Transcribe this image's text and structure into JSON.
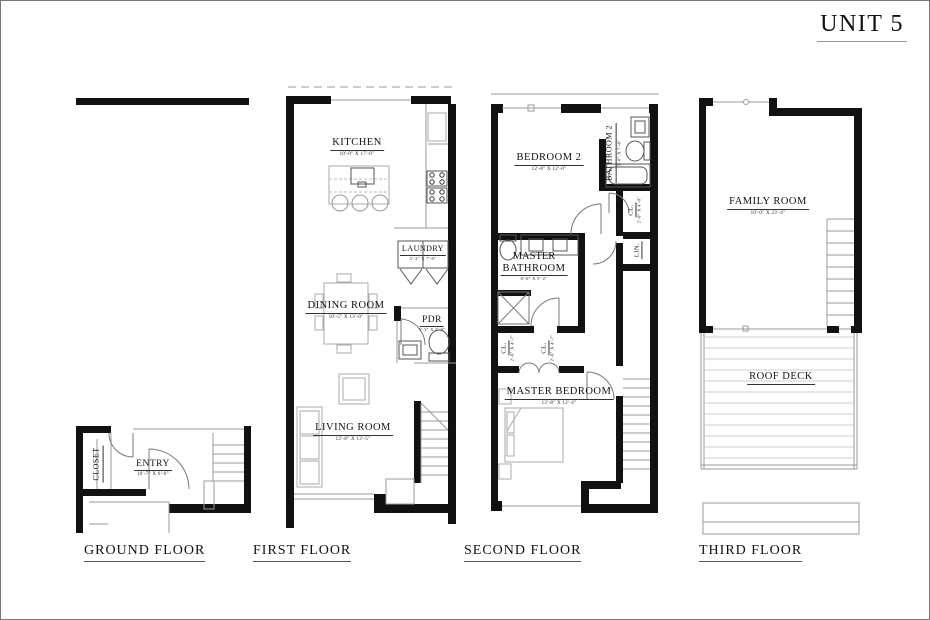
{
  "title": "UNIT 5",
  "colors": {
    "wall": "#111111",
    "thin_line": "#999999"
  },
  "floors": {
    "ground": {
      "label": "GROUND FLOOR",
      "rooms": {
        "closet": {
          "name": "CLOSET"
        },
        "entry": {
          "name": "ENTRY",
          "dims": "10'-7\" X 6'-0\""
        }
      }
    },
    "first": {
      "label": "FIRST FLOOR",
      "rooms": {
        "kitchen": {
          "name": "KITCHEN",
          "dims": "10'-0\" X 17'-0\""
        },
        "laundry": {
          "name": "LAUNDRY",
          "dims": "5'-2\" X 7'-0\""
        },
        "dining": {
          "name": "DINING ROOM",
          "dims": "10'-5\" X 13'-0\""
        },
        "pdr": {
          "name": "PDR",
          "dims": "5'-3\" X 5'-0\""
        },
        "living": {
          "name": "LIVING ROOM",
          "dims": "12'-8\" X 13'-5\""
        }
      }
    },
    "second": {
      "label": "SECOND FLOOR",
      "rooms": {
        "bedroom2": {
          "name": "BEDROOM 2",
          "dims": "12'-8\" X 12'-0\""
        },
        "bathroom2": {
          "name": "BATHROOM 2",
          "dims": "5'-0\" X 7'-8\""
        },
        "closet_hall": {
          "name": "CL.",
          "dims": "2'-0\" X 4'-0\""
        },
        "linen": {
          "name": "LIN."
        },
        "master_bathroom": {
          "name_line1": "MASTER",
          "name_line2": "BATHROOM",
          "dims": "8'-0\" X 9'-2\""
        },
        "closet_left": {
          "name": "CL.",
          "dims": "2'-0\" X 4'-7\""
        },
        "closet_right": {
          "name": "CL.",
          "dims": "2'-0\" X 4'-7\""
        },
        "master_bedroom": {
          "name": "MASTER BEDROOM",
          "dims": "12'-8\" X 12'-4\""
        }
      }
    },
    "third": {
      "label": "THIRD FLOOR",
      "rooms": {
        "family": {
          "name": "FAMILY ROOM",
          "dims": "10'-0\" X 23'-4\""
        },
        "roof_deck": {
          "name": "ROOF DECK"
        }
      }
    }
  }
}
